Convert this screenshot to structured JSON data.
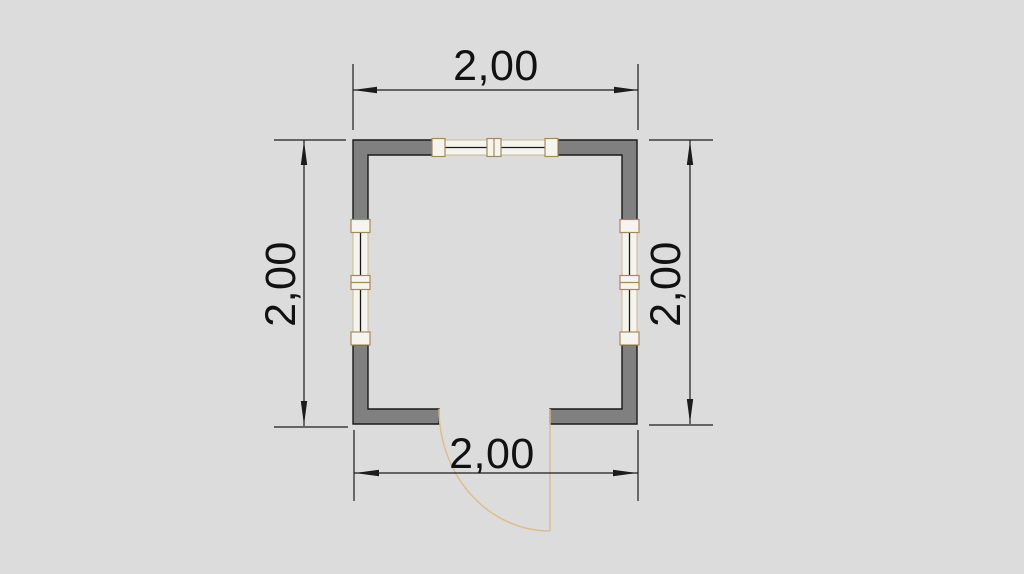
{
  "drawing": {
    "type": "architectural floor plan (CAD)",
    "room_width_label": "2,00",
    "room_depth_label": "2,00"
  },
  "dimensions": {
    "top": "2,00",
    "left": "2,00",
    "right": "2,00",
    "bottom": "2,00"
  },
  "colors": {
    "background": "#dcdcdc",
    "wall_fill": "#808080",
    "wall_stroke": "#1a1a1a",
    "window_fill": "#f6f4ee",
    "window_strip_stroke": "#ccb88e",
    "window_frame_stroke": "#a5895a",
    "glass_line": "#1a1a1a",
    "door": "#d9c08c",
    "dimension_line": "#1c1c1c",
    "dimension_text": "#111111"
  }
}
